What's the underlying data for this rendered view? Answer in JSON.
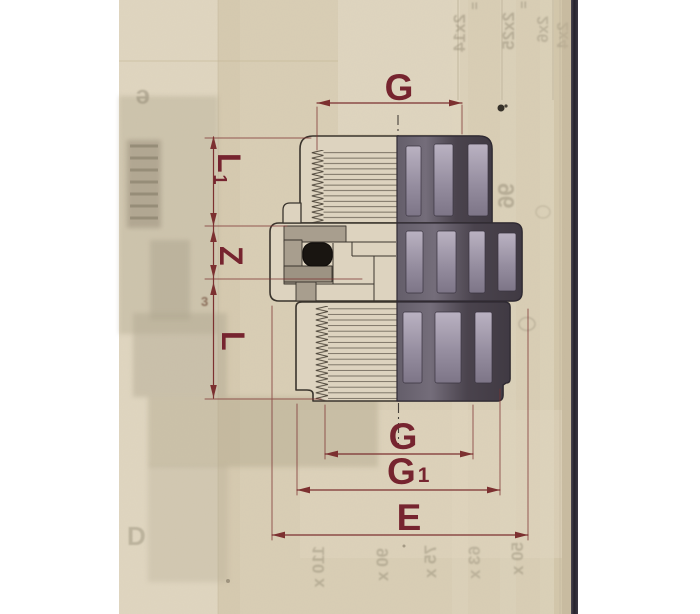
{
  "scan": {
    "type": "scanned catalog page",
    "subject": "threaded union fitting cross-section technical drawing"
  },
  "dimensions": {
    "g_top": "G",
    "l1_main": "L",
    "l1_sub": "1",
    "z": "Z",
    "l": "L",
    "g_bottom": "G",
    "g1_main": "G",
    "g1_sub": "1",
    "e": "E"
  },
  "ghost_text": {
    "eq1": "=",
    "eq2": "=",
    "col1": "2x14",
    "col2": "2x25",
    "col3": "2x6",
    "col4": "2x4",
    "num96": "96",
    "row110": "110 x",
    "row90": "90 x",
    "row75": "75 x",
    "row63": "63 x",
    "row50": "50 x",
    "letter_e": "e",
    "letter_d": "D",
    "mark3": "3"
  },
  "colors": {
    "dimension_red": "#76242f",
    "paper": "#d9ceb5",
    "outline_ink": "#3a342d",
    "body_dark": "#4a434d",
    "section_gray": "#a89e8e",
    "oring_black": "#191511",
    "page_edge": "#2e2b35"
  }
}
